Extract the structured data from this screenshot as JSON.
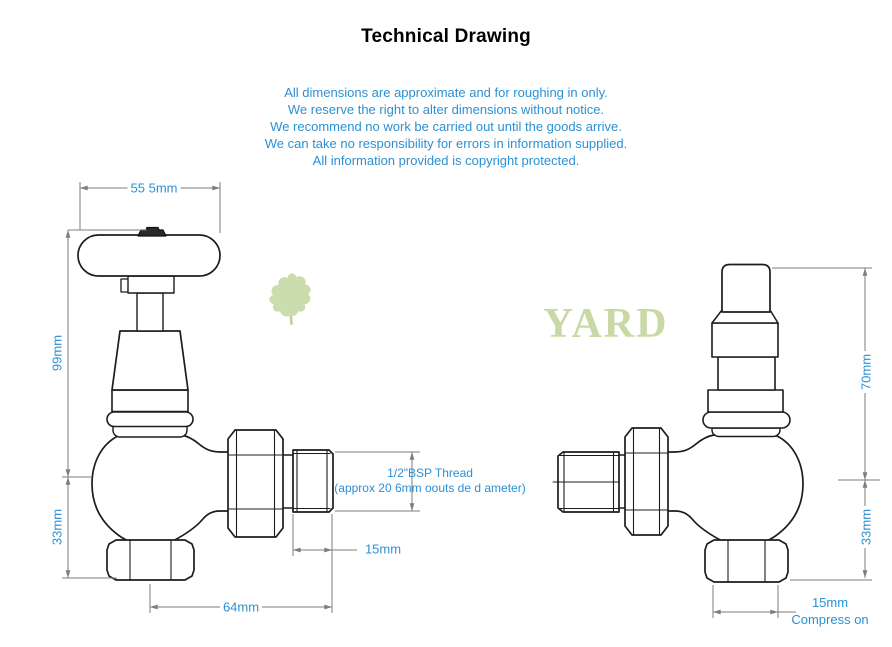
{
  "title": "Technical Drawing",
  "disclaimer": {
    "lines": [
      "All dimensions are approximate and for roughing in only.",
      "We reserve the right to alter dimensions without notice.",
      "We recommend no work be carried out until the goods arrive.",
      "We can take no responsibility for errors in information supplied.",
      "All information provided is copyright protected."
    ]
  },
  "watermark": {
    "brand": "YARD",
    "leaf_icon": "oak-leaf-icon"
  },
  "left_valve": {
    "description": "angled manual radiator valve side elevation",
    "dimensions": {
      "handle_width": "55 5mm",
      "height_upper": "99mm",
      "height_lower": "33mm",
      "overall_length": "64mm",
      "thread_length": "15mm",
      "thread_note_line1": "1/2\"BSP Thread",
      "thread_note_line2": "(approx 20 6mm oouts de d ameter)"
    }
  },
  "right_valve": {
    "description": "lockshield radiator valve side elevation",
    "dimensions": {
      "height_upper": "70mm",
      "height_lower": "33mm",
      "compression_size": "15mm",
      "compression_label": "Compress on"
    }
  },
  "colors": {
    "accent_text": "#2b90d4",
    "drawing_line": "#1c1c1c",
    "dimension_line": "#7d7d7d",
    "watermark_green": "#cbdcad"
  }
}
